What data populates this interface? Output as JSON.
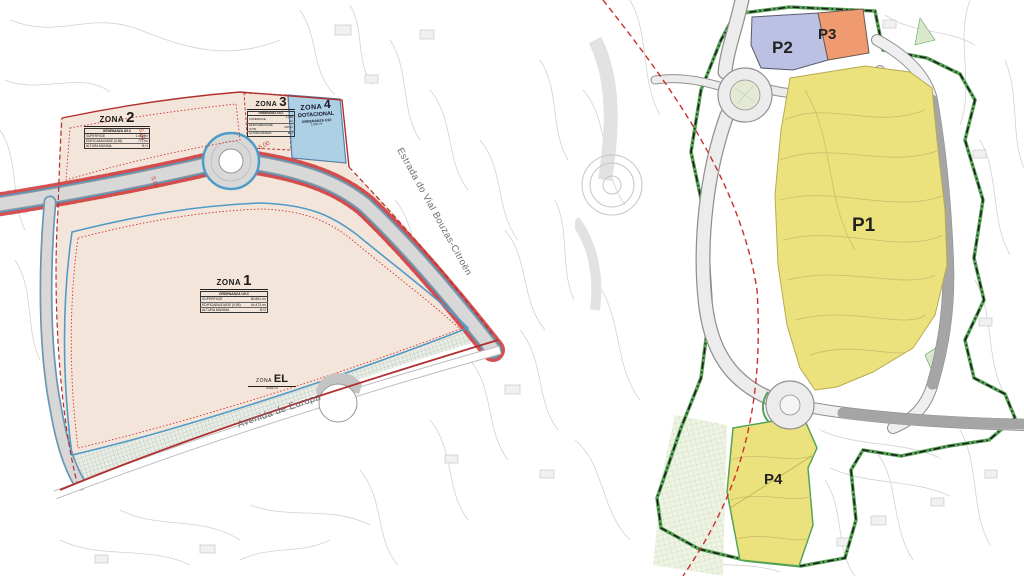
{
  "page": {
    "title": "Plan de ordenación - zonas e parcelas"
  },
  "colors": {
    "beige": "#f3e4d8",
    "yellow": "#ebe17d",
    "lavender": "#bcc1e3",
    "orange": "#ef9a70",
    "zone_blue": "#aed0e4",
    "red_boundary": "#c0392b",
    "blue_line": "#4f9bc8",
    "green_boundary": "#56a356",
    "road_gray": "#d8d8d8"
  },
  "left_map": {
    "zona1": {
      "label": "ZONA",
      "num": "1",
      "ordenanza": "ORDENANZA U9.C",
      "rows": [
        [
          "SUPERFICIE",
          "80.861 m²"
        ],
        [
          "EDIFICABILIDADE (0,55)",
          "44.473 m²"
        ],
        [
          "ALTURA MÁXIMA",
          "B+2"
        ]
      ]
    },
    "zona2": {
      "label": "ZONA",
      "num": "2",
      "ordenanza": "ORDENANZA U9.C",
      "rows": [
        [
          "SUPERFICIE",
          "1.402 m²"
        ],
        [
          "EDIFICABILIDADE (0,55)",
          "771 m²"
        ],
        [
          "ALTURA MÁXIMA",
          "B+1"
        ]
      ]
    },
    "zona3": {
      "label": "ZONA",
      "num": "3",
      "ordenanza": "ORDENANZA U9.C",
      "rows": [
        [
          "SUPERFICIE",
          "1.186 m²"
        ],
        [
          "EDIFICABILIDADE (0,55)",
          "652 m²"
        ],
        [
          "ALTURA MÁXIMA",
          "B+1"
        ]
      ]
    },
    "zona4": {
      "label": "ZONA",
      "num": "4",
      "line2": "DOTACIONAL",
      "ordenanza": "ORDENANZA U10",
      "area": "1.500 m²"
    },
    "zonaEL": {
      "label": "ZONA",
      "num": "EL",
      "area": "9.022 m²"
    },
    "road_estrada": "Estrada do Vial Bouzas-Citroën",
    "road_avenida": "Avenida de Europa",
    "dims": [
      "5.00",
      "5.00",
      "5.00"
    ]
  },
  "right_map": {
    "parcels": [
      {
        "id": "P1"
      },
      {
        "id": "P2"
      },
      {
        "id": "P3"
      },
      {
        "id": "P4"
      }
    ]
  }
}
